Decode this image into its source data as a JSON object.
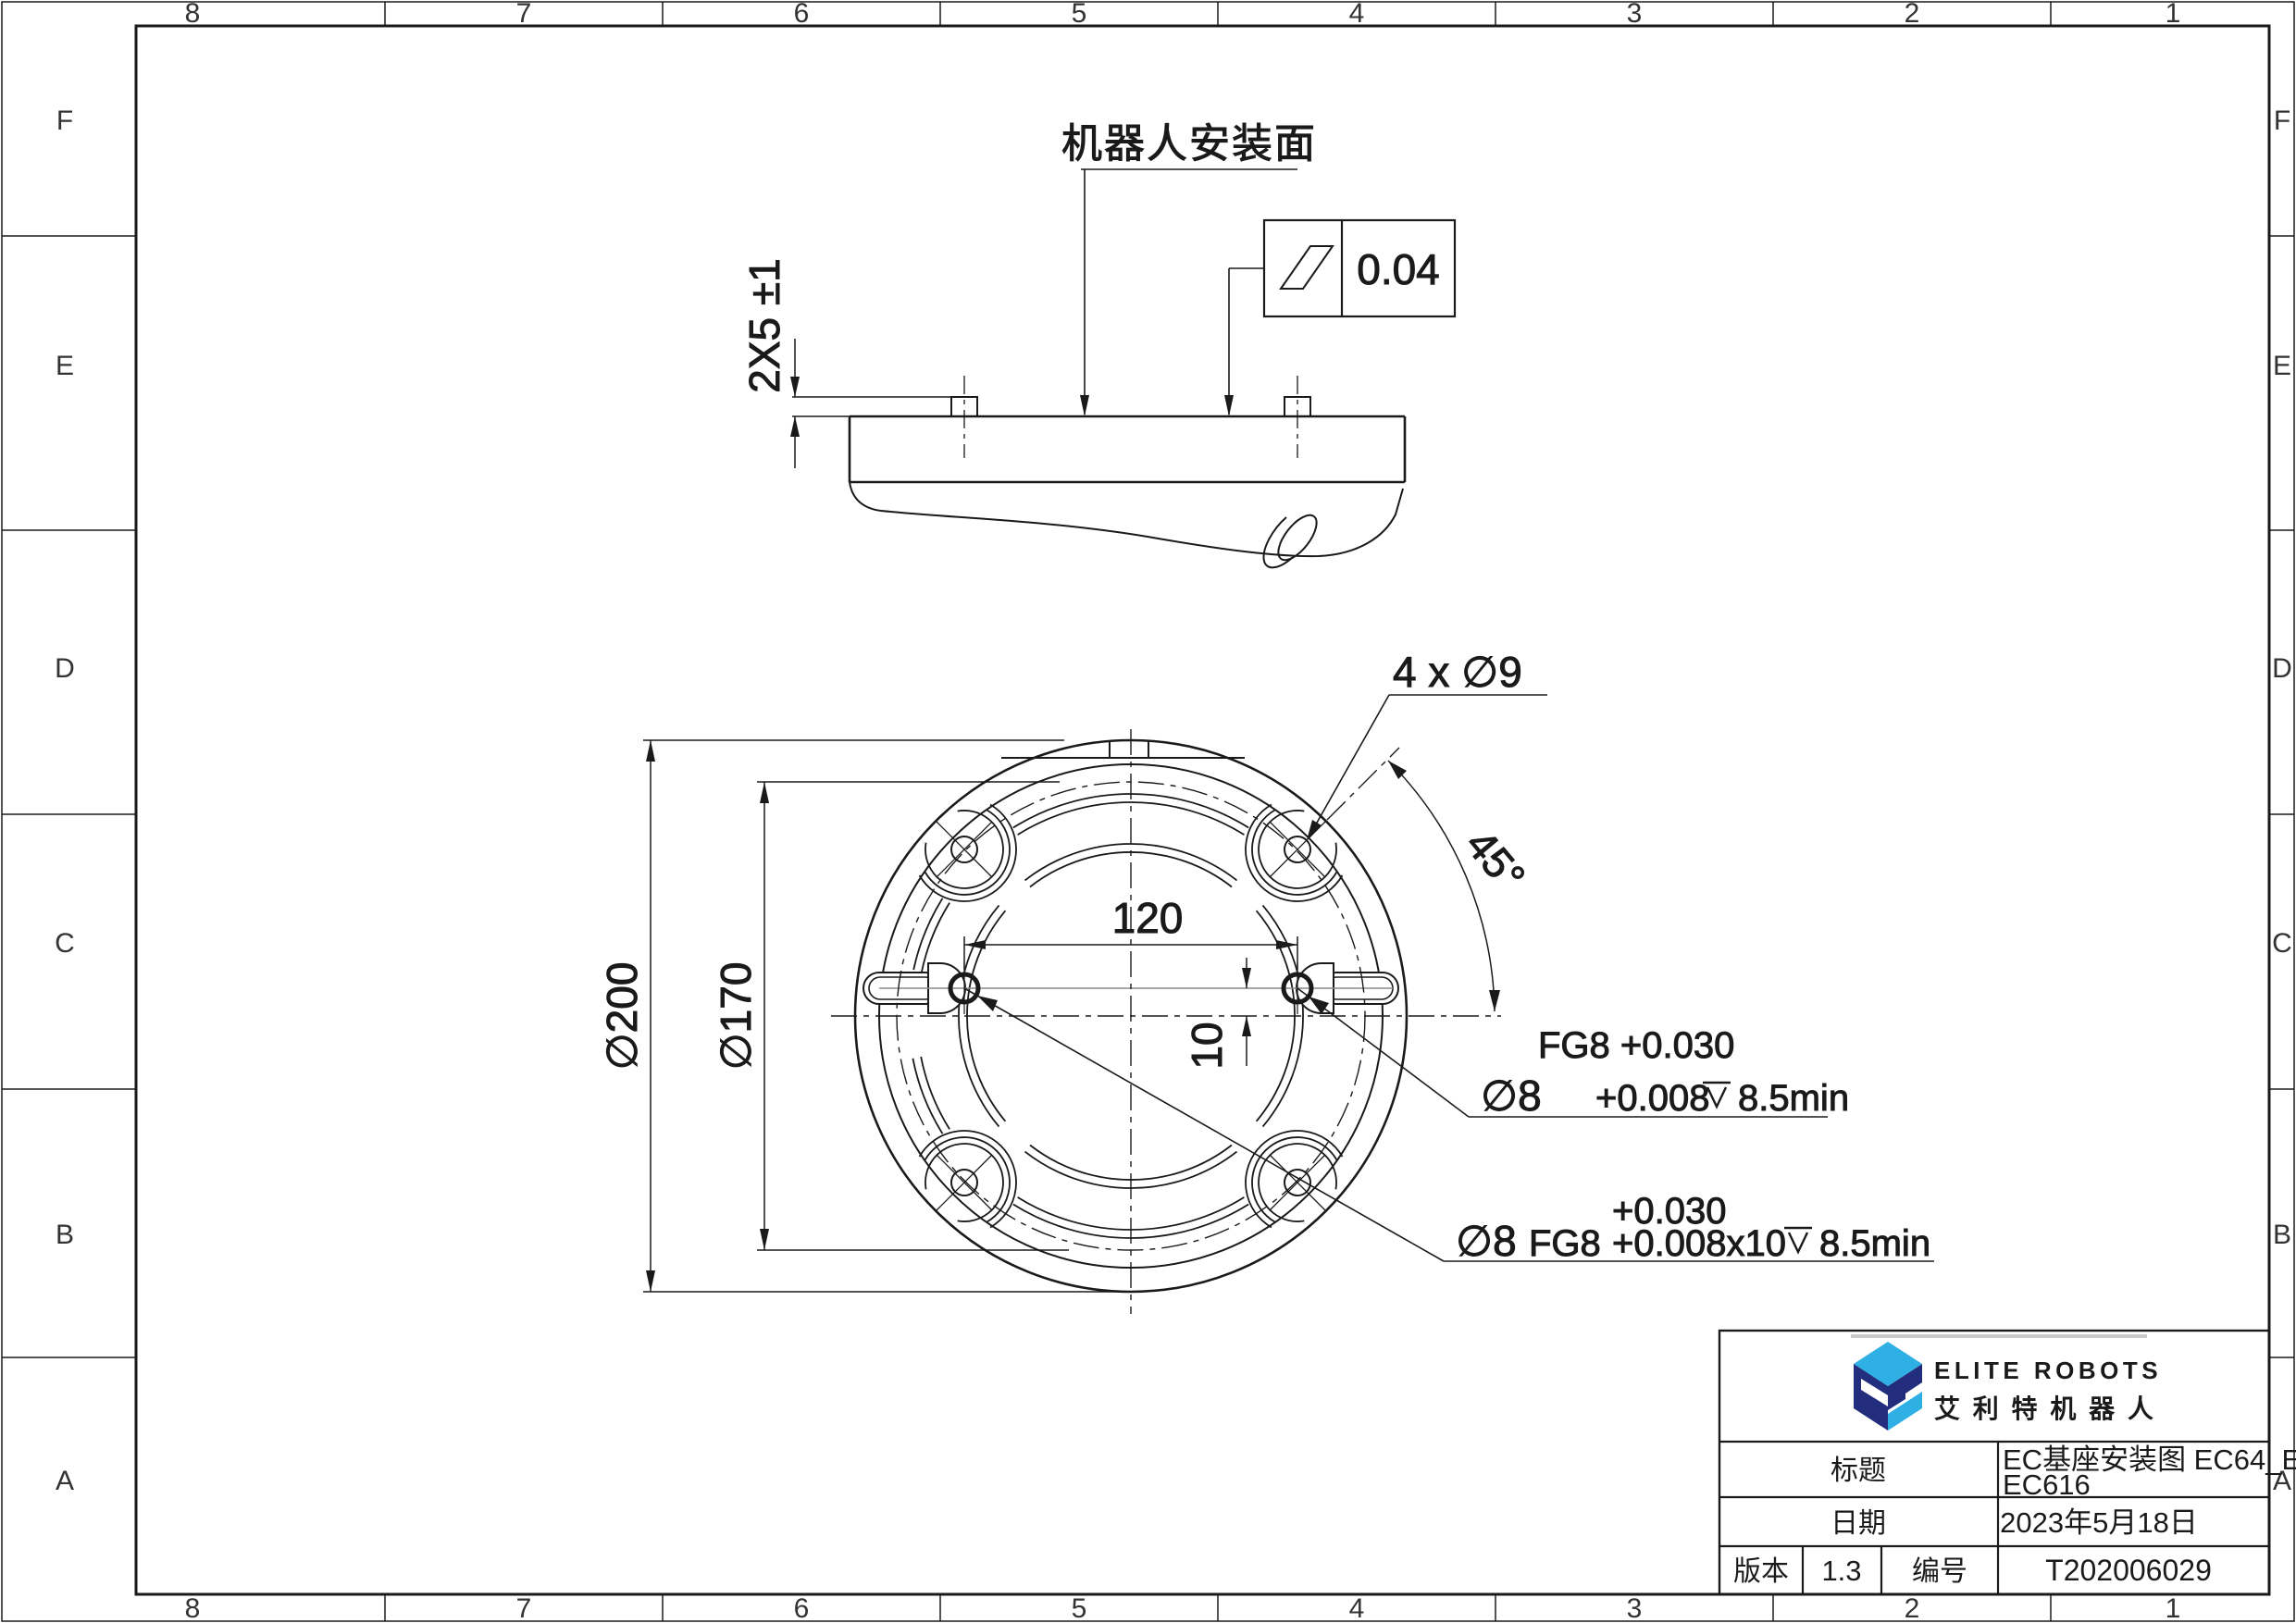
{
  "sheet": {
    "grid_columns": [
      "8",
      "7",
      "6",
      "5",
      "4",
      "3",
      "2",
      "1"
    ],
    "grid_rows": [
      "F",
      "E",
      "D",
      "C",
      "B",
      "A"
    ]
  },
  "side_view": {
    "surface_label": "机器人安装面",
    "flatness_value": "0.04",
    "pin_dim": "2X5 ±1"
  },
  "plan_view": {
    "holes_callout": "4 x ∅9",
    "angle_dim": "45°",
    "outer_dia": "∅200",
    "bolt_circle_dia": "∅170",
    "pin_spacing": "120",
    "pin_offset": "10",
    "callout_upper": {
      "line1": "FG8 +0.030",
      "dia": "∅8",
      "tol": "+0.008",
      "depth": "8.5min"
    },
    "callout_lower": {
      "tol_top": "+0.030",
      "dia": "∅8",
      "fit": "FG8",
      "tol": "+0.008x10",
      "depth": "8.5min"
    }
  },
  "title_block": {
    "logo_text": "ELITE ROBOTS",
    "logo_text_cn": "艾 利 特 机 器 人",
    "title_label": "标题",
    "title_value_line1": "EC基座安装图 EC64_EC612_",
    "title_value_line2": "EC616",
    "date_label": "日期",
    "date_value": "2023年5月18日",
    "version_label": "版本",
    "version_value": "1.3",
    "number_label": "编号",
    "number_value": "T202006029"
  },
  "colors": {
    "line": "#1a1a1a",
    "logo_navy": "#222e7d",
    "logo_blue": "#2fb0e5"
  }
}
